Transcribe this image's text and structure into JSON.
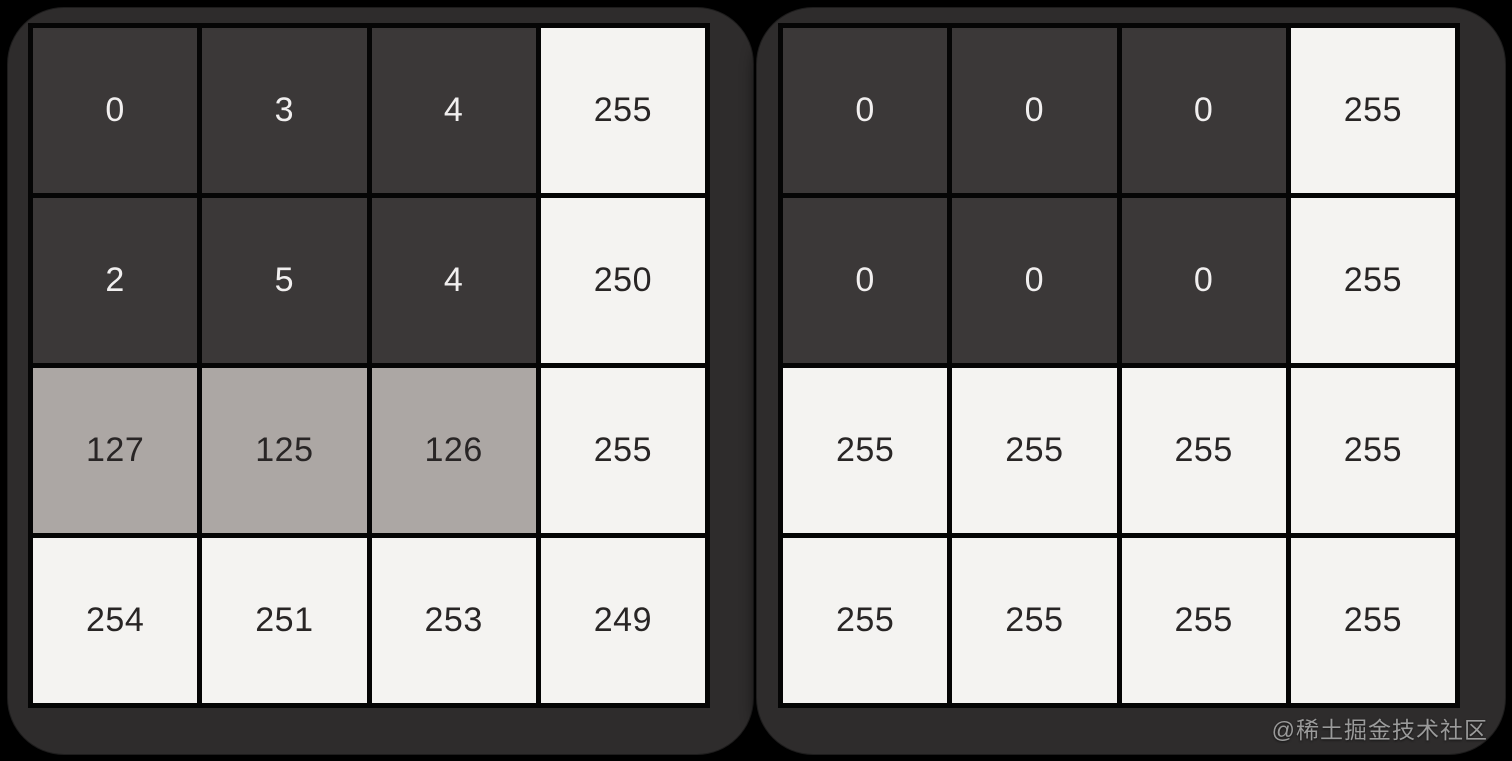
{
  "matrices": {
    "left": {
      "rows": [
        [
          0,
          3,
          4,
          255
        ],
        [
          2,
          5,
          4,
          250
        ],
        [
          127,
          125,
          126,
          255
        ],
        [
          254,
          251,
          253,
          249
        ]
      ]
    },
    "right": {
      "rows": [
        [
          0,
          0,
          0,
          255
        ],
        [
          0,
          0,
          0,
          255
        ],
        [
          255,
          255,
          255,
          255
        ],
        [
          255,
          255,
          255,
          255
        ]
      ]
    }
  },
  "shade_thresholds": {
    "dark_below": 64,
    "mid_below": 200
  },
  "watermark": {
    "text": "@稀土掘金技术社区"
  },
  "colors": {
    "background": "#000000",
    "panel": "#2e2c2c",
    "grid_line": "#050505",
    "cell_dark": "#3b3838",
    "cell_mid": "#aca7a4",
    "cell_light": "#f4f3f1",
    "text_on_dark": "#f1efef",
    "text_on_light": "#282525",
    "watermark": "#9a9a9a"
  }
}
